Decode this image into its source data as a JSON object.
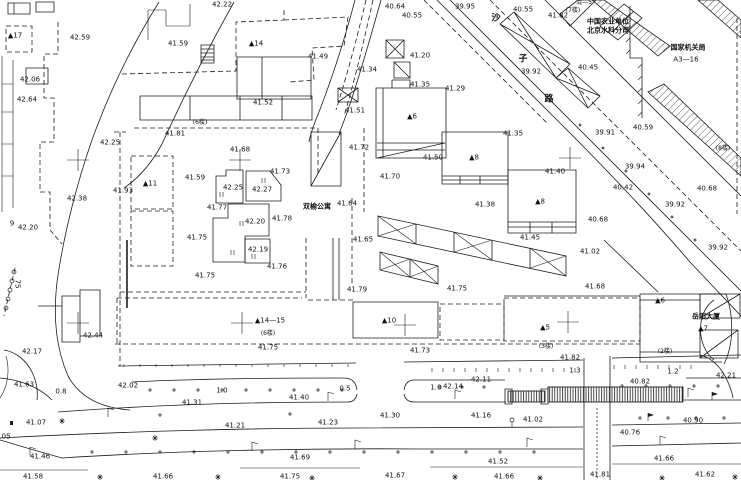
{
  "document": {
    "type": "topographic-survey-plan",
    "colors": {
      "ink": "#1c1c1c",
      "background": "#ffffff"
    }
  },
  "map": {
    "labels": [
      [
        "42.22",
        222,
        5
      ],
      [
        "40.64",
        395,
        7
      ],
      [
        "39.95",
        465,
        7
      ],
      [
        "40.55",
        412,
        16
      ],
      [
        "40.55",
        523,
        10
      ],
      [
        "41.82",
        558,
        16
      ],
      [
        "▲17",
        15,
        36,
        "bld"
      ],
      [
        "42.59",
        80,
        38
      ],
      [
        "41.59",
        178,
        44
      ],
      [
        "▲14",
        256,
        44,
        "bld"
      ],
      [
        "41.49",
        318,
        57
      ],
      [
        "41.20",
        420,
        56
      ],
      [
        "41.34",
        367,
        70
      ],
      [
        "40.45",
        588,
        68
      ],
      [
        "39.92",
        531,
        72
      ],
      [
        "42.06",
        30,
        80
      ],
      [
        "41.35",
        420,
        85
      ],
      [
        "41.29",
        455,
        89
      ],
      [
        "42.64",
        27,
        100
      ],
      [
        "41.52",
        263,
        103
      ],
      [
        "41.51",
        355,
        111
      ],
      [
        "▲6",
        412,
        117,
        "bld"
      ],
      [
        "(7楼)",
        573,
        11,
        "sm"
      ],
      [
        "混—5",
        584,
        3,
        "sm"
      ],
      [
        "沙",
        496,
        19,
        "rd"
      ],
      [
        "子",
        523,
        60,
        "rd"
      ],
      [
        "路",
        549,
        100,
        "rd"
      ],
      [
        "中国农业单位",
        608,
        22,
        "cn"
      ],
      [
        "北京水科分司",
        608,
        31,
        "cn"
      ],
      [
        "国家机关局",
        688,
        48,
        "cn"
      ],
      [
        "A3—16",
        686,
        60
      ],
      [
        "(6楼)",
        200,
        123,
        "sm"
      ],
      [
        "41.81",
        175,
        134
      ],
      [
        "40.59",
        643,
        128
      ],
      [
        "41.68",
        240,
        150
      ],
      [
        "39.91",
        605,
        133
      ],
      [
        "41.35",
        513,
        134
      ],
      [
        "42.25",
        110,
        143
      ],
      [
        "▲8",
        474,
        158,
        "bld"
      ],
      [
        "(8楼)",
        723,
        149,
        "sm"
      ],
      [
        "41.40",
        555,
        172
      ],
      [
        "41.72",
        359,
        148
      ],
      [
        "41.50",
        433,
        158
      ],
      [
        "41.73",
        280,
        172
      ],
      [
        "41.59",
        195,
        178
      ],
      [
        "39.94",
        635,
        167
      ],
      [
        "41.70",
        390,
        177
      ],
      [
        "▲11",
        150,
        184,
        "bld"
      ],
      [
        "42.25",
        233,
        188
      ],
      [
        "42.27",
        262,
        190
      ],
      [
        "40.42",
        623,
        188
      ],
      [
        "40.68",
        707,
        189
      ],
      [
        "41.93",
        123,
        191
      ],
      [
        "42.38",
        77,
        199
      ],
      [
        "▲8",
        540,
        202,
        "bld"
      ],
      [
        "双榆公寓",
        317,
        207,
        "cn"
      ],
      [
        "41.64",
        347,
        204
      ],
      [
        "41.38",
        485,
        205
      ],
      [
        "41.77",
        217,
        208
      ],
      [
        "39.92",
        675,
        205
      ],
      [
        "40.68",
        598,
        220
      ],
      [
        "42.20",
        255,
        222
      ],
      [
        "41.78",
        282,
        219
      ],
      [
        "9",
        12,
        224
      ],
      [
        "42.20",
        28,
        228
      ],
      [
        "41.75",
        197,
        238
      ],
      [
        "41.65",
        363,
        240
      ],
      [
        "41.45",
        530,
        238
      ],
      [
        "39.92",
        718,
        248
      ],
      [
        "42.19",
        258,
        250
      ],
      [
        "41.02",
        590,
        252
      ],
      [
        "41.76",
        277,
        267
      ],
      [
        "41.75",
        205,
        276
      ],
      [
        "75",
        17,
        284,
        "vert"
      ],
      [
        "41.79",
        357,
        290
      ],
      [
        "41.75",
        457,
        289
      ],
      [
        "41.68",
        595,
        287
      ],
      [
        "▲6",
        660,
        301,
        "bld"
      ],
      [
        "▲14—15",
        270,
        321,
        "bld"
      ],
      [
        "▲10",
        389,
        321,
        "bld"
      ],
      [
        "▲5",
        545,
        328,
        "bld"
      ],
      [
        "岳阳大厦",
        706,
        317,
        "cn"
      ],
      [
        "▲7",
        703,
        329,
        "bld"
      ],
      [
        "(6楼)",
        268,
        334,
        "sm"
      ],
      [
        "42.44",
        93,
        336
      ],
      [
        "(3楼)",
        546,
        347,
        "sm"
      ],
      [
        "41.75",
        268,
        348
      ],
      [
        "41.73",
        420,
        351
      ],
      [
        "(2楼)",
        665,
        352,
        "sm"
      ],
      [
        "42.17",
        32,
        352
      ],
      [
        "41.82",
        570,
        358
      ],
      [
        "41.63",
        24,
        385
      ],
      [
        "1.3",
        575,
        371
      ],
      [
        "1.2",
        673,
        372
      ],
      [
        "42.21",
        726,
        376
      ],
      [
        "42.11",
        481,
        380
      ],
      [
        "0.8",
        61,
        392
      ],
      [
        "42.02",
        128,
        386
      ],
      [
        "1.0",
        222,
        391
      ],
      [
        "0.5",
        345,
        389
      ],
      [
        "42.14",
        453,
        387
      ],
      [
        "1.0",
        436,
        388
      ],
      [
        "40.82",
        640,
        382
      ],
      [
        "41.40",
        299,
        398
      ],
      [
        "41.31",
        192,
        403
      ],
      [
        "41.30",
        390,
        416
      ],
      [
        "41.16",
        481,
        416
      ],
      [
        "41.07",
        36,
        423
      ],
      [
        "41.23",
        328,
        423
      ],
      [
        "41.21",
        235,
        426
      ],
      [
        "41.02",
        533,
        420
      ],
      [
        "40.90",
        693,
        421
      ],
      [
        "40.76",
        630,
        433
      ],
      [
        ".05",
        5,
        437
      ],
      [
        "41.46",
        40,
        457
      ],
      [
        "41.69",
        300,
        458
      ],
      [
        "41.66",
        664,
        459
      ],
      [
        "41.52",
        498,
        462
      ],
      [
        "41.58",
        33,
        477
      ],
      [
        "41.66",
        163,
        477
      ],
      [
        "41.75",
        290,
        477
      ],
      [
        "41.67",
        395,
        476
      ],
      [
        "41.66",
        504,
        477
      ],
      [
        "41.81",
        600,
        475
      ],
      [
        "41.62",
        705,
        475
      ]
    ],
    "grid_crosses": [
      [
        78,
        160
      ],
      [
        240,
        160
      ],
      [
        570,
        158
      ],
      [
        78,
        323
      ],
      [
        242,
        323
      ],
      [
        405,
        325
      ],
      [
        568,
        322
      ]
    ]
  }
}
